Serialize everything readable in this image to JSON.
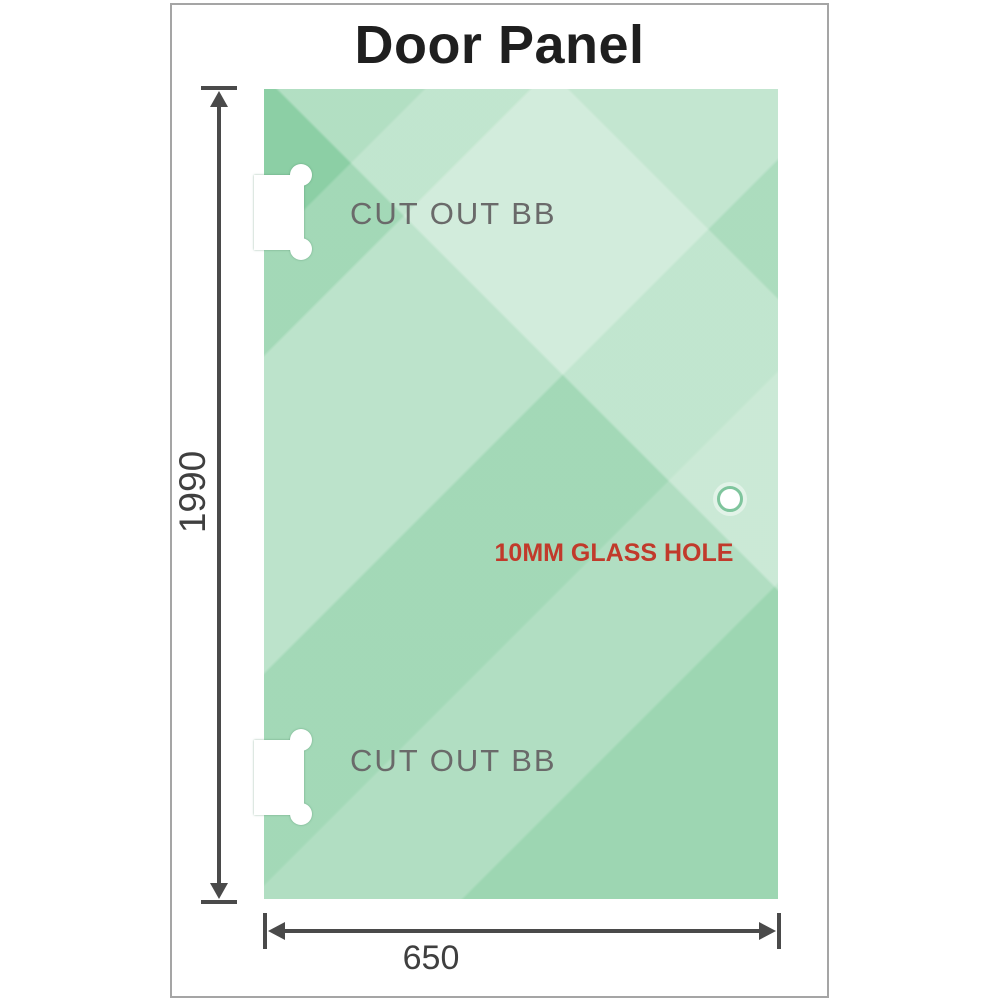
{
  "title": "Door Panel",
  "panel": {
    "cutout_top_label": "CUT OUT BB",
    "cutout_bottom_label": "CUT OUT BB",
    "hole_label": "10MM GLASS HOLE"
  },
  "dimensions": {
    "height_value": "1990",
    "width_value": "650"
  },
  "colors": {
    "glass_base": "#8ccfa5",
    "glass_highlight": "#c9ebd6",
    "dimension_lines": "#4a4a4a",
    "hole_label_red": "#c13a2b",
    "cutout_label_gray": "#6a6a6a",
    "frame_border": "#a5a5a5",
    "title_text": "#1f1f1f"
  }
}
